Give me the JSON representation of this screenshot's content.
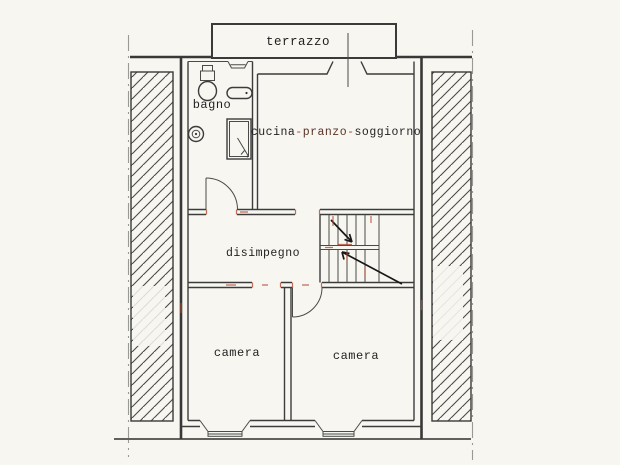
{
  "colors": {
    "background": "#f7f6f1",
    "ink": "#1f1f1f",
    "wall": "#3a3a3a",
    "accent_red": "#b5492f",
    "pranzo_ink": "#5a3328",
    "property_line": "#9a9a94"
  },
  "rooms": {
    "terrace": {
      "label": "terrazzo"
    },
    "bathroom": {
      "label": "bagno"
    },
    "living": {
      "part1": "cucina",
      "dash1": "-",
      "part2": "pranzo",
      "dash2": "-",
      "part3": "soggiorno"
    },
    "hallway": {
      "label": "disimpegno"
    },
    "bedroom_left": {
      "label": "camera"
    },
    "bedroom_right": {
      "label": "camera"
    }
  }
}
